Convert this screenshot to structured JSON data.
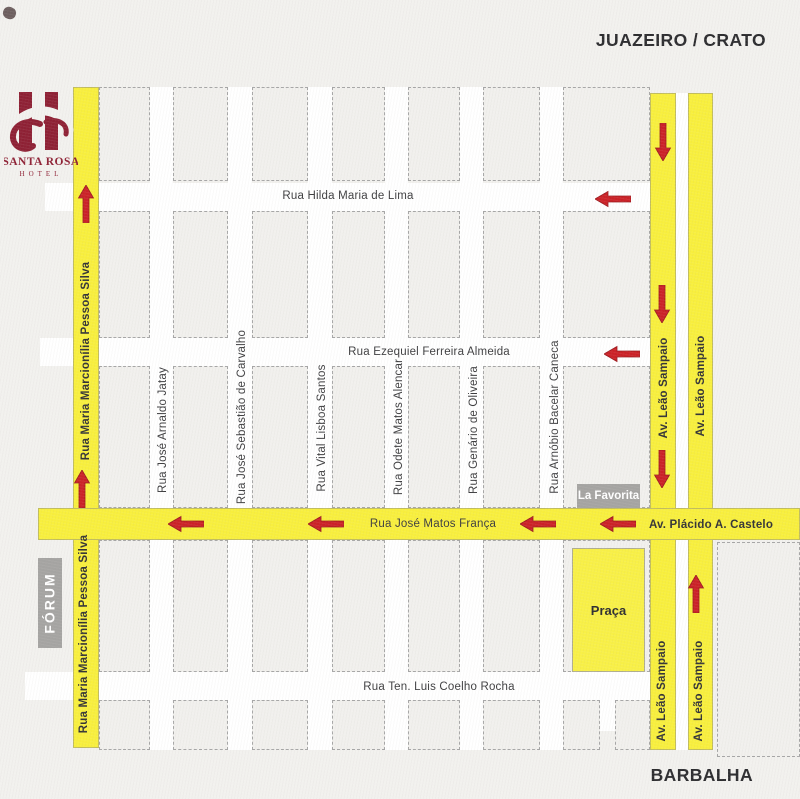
{
  "scene": {
    "top_right_label": "JUAZEIRO / CRATO",
    "bottom_right_label": "BARBALHA"
  },
  "logo": {
    "title": "SANTA ROSA",
    "subtitle": "HOTEL"
  },
  "colors": {
    "background": "#f2f1ee",
    "street_white": "#ffffff",
    "street_yellow": "#f8ef3d",
    "praca_yellow": "#f8f046",
    "block_border": "#a6a6a6",
    "arrow_red": "#cb2127",
    "arrow_red_dark": "#9b1b1f",
    "text_dark": "#3d3d3f",
    "logo_maroon": "#8e2034",
    "landmark_gray": "#a5a4a2"
  },
  "map": {
    "streets": [
      {
        "id": "rua-hilda-maria-de-lima",
        "orientation": "h",
        "color": "white",
        "rect": [
          45,
          183,
          605,
          28
        ]
      },
      {
        "id": "rua-ezequiel-ferreira-almeida",
        "orientation": "h",
        "color": "white",
        "rect": [
          40,
          338,
          610,
          28
        ]
      },
      {
        "id": "rua-ten-luis-coelho-rocha",
        "orientation": "h",
        "color": "white",
        "rect": [
          25,
          672,
          625,
          28
        ]
      },
      {
        "id": "rua-jose-arnaldo-jatay",
        "orientation": "v",
        "color": "white",
        "rect": [
          150,
          87,
          23,
          663
        ]
      },
      {
        "id": "rua-jose-sebastiao-de-carvalho",
        "orientation": "v",
        "color": "white",
        "rect": [
          228,
          87,
          24,
          663
        ]
      },
      {
        "id": "rua-vital-lisboa-santos",
        "orientation": "v",
        "color": "white",
        "rect": [
          308,
          87,
          24,
          663
        ]
      },
      {
        "id": "rua-odete-matos-alencar",
        "orientation": "v",
        "color": "white",
        "rect": [
          385,
          87,
          23,
          663
        ]
      },
      {
        "id": "rua-genario-de-oliveira",
        "orientation": "v",
        "color": "white",
        "rect": [
          460,
          87,
          23,
          663
        ]
      },
      {
        "id": "rua-arnobio-bacelar-caneca",
        "orientation": "v",
        "color": "white",
        "rect": [
          540,
          87,
          23,
          663
        ]
      },
      {
        "id": "av-leao-sampaio-median",
        "orientation": "v",
        "color": "white",
        "rect": [
          650,
          93,
          63,
          657
        ]
      },
      {
        "id": "small-lane-stub",
        "orientation": "v",
        "color": "white",
        "rect": [
          600,
          700,
          15,
          31
        ]
      },
      {
        "id": "rua-maria-marcionilia-pessoa-silva",
        "orientation": "v",
        "color": "yellow",
        "rect": [
          73,
          87,
          26,
          661
        ]
      },
      {
        "id": "av-leao-sampaio-west",
        "orientation": "v",
        "color": "yellow",
        "rect": [
          650,
          93,
          26,
          657
        ]
      },
      {
        "id": "av-leao-sampaio-east",
        "orientation": "v",
        "color": "yellow",
        "rect": [
          688,
          93,
          25,
          657
        ]
      },
      {
        "id": "rua-jose-matos-franca-av-placido-a-castelo",
        "orientation": "h",
        "color": "yellow",
        "rect": [
          38,
          508,
          762,
          32
        ]
      }
    ],
    "labels": [
      {
        "text": "Rua Hilda Maria de Lima",
        "x": 348,
        "y": 196,
        "rotate": false,
        "bold": false
      },
      {
        "text": "Rua Ezequiel Ferreira Almeida",
        "x": 429,
        "y": 352,
        "rotate": false,
        "bold": false
      },
      {
        "text": "Rua José Matos França",
        "x": 433,
        "y": 524,
        "rotate": false,
        "bold": false
      },
      {
        "text": "Av. Plácido A. Castelo",
        "x": 711,
        "y": 525,
        "rotate": false,
        "bold": true
      },
      {
        "text": "Rua Ten. Luis Coelho Rocha",
        "x": 439,
        "y": 687,
        "rotate": false,
        "bold": false
      },
      {
        "text": "Rua Maria Marcionília Pessoa Silva",
        "x": 86,
        "y": 361,
        "rotate": true,
        "bold": true
      },
      {
        "text": "Rua Maria Marcionília Pessoa Silva",
        "x": 84,
        "y": 634,
        "rotate": true,
        "bold": true
      },
      {
        "text": "Rua José Arnaldo Jatay",
        "x": 163,
        "y": 430,
        "rotate": true,
        "bold": false
      },
      {
        "text": "Rua José Sebastião de Carvalho",
        "x": 242,
        "y": 417,
        "rotate": true,
        "bold": false
      },
      {
        "text": "Rua Vital Lisboa Santos",
        "x": 322,
        "y": 428,
        "rotate": true,
        "bold": false
      },
      {
        "text": "Rua Odete Matos Alencar",
        "x": 399,
        "y": 427,
        "rotate": true,
        "bold": false
      },
      {
        "text": "Rua Genário de Oliveira",
        "x": 474,
        "y": 430,
        "rotate": true,
        "bold": false
      },
      {
        "text": "Rua Arnóbio Bacelar Caneca",
        "x": 555,
        "y": 417,
        "rotate": true,
        "bold": false
      },
      {
        "text": "Av. Leão Sampaio",
        "x": 664,
        "y": 388,
        "rotate": true,
        "bold": true
      },
      {
        "text": "Av. Leão Sampaio",
        "x": 701,
        "y": 386,
        "rotate": true,
        "bold": true
      },
      {
        "text": "Av. Leão Sampaio",
        "x": 662,
        "y": 691,
        "rotate": true,
        "bold": true
      },
      {
        "text": "Av. Leão Sampaio",
        "x": 699,
        "y": 691,
        "rotate": true,
        "bold": true
      }
    ],
    "arrows": [
      {
        "dir": "up",
        "x": 86,
        "y": 204
      },
      {
        "dir": "up",
        "x": 82,
        "y": 489
      },
      {
        "dir": "up",
        "x": 696,
        "y": 594
      },
      {
        "dir": "down",
        "x": 663,
        "y": 142
      },
      {
        "dir": "down",
        "x": 662,
        "y": 304
      },
      {
        "dir": "down",
        "x": 662,
        "y": 469
      },
      {
        "dir": "left",
        "x": 613,
        "y": 199
      },
      {
        "dir": "left",
        "x": 622,
        "y": 354
      },
      {
        "dir": "left",
        "x": 186,
        "y": 524
      },
      {
        "dir": "left",
        "x": 326,
        "y": 524
      },
      {
        "dir": "left",
        "x": 538,
        "y": 524
      },
      {
        "dir": "left",
        "x": 618,
        "y": 524
      }
    ],
    "landmarks": [
      {
        "label": "FÓRUM",
        "style": "gray",
        "rect": [
          38,
          558,
          24,
          90
        ],
        "rotate": true
      },
      {
        "label": "La Favorita",
        "style": "gray",
        "rect": [
          577,
          484,
          63,
          24
        ],
        "rotate": false
      },
      {
        "label": "Praça",
        "style": "yellow",
        "rect": [
          572,
          548,
          73,
          124
        ],
        "rotate": false
      }
    ]
  }
}
